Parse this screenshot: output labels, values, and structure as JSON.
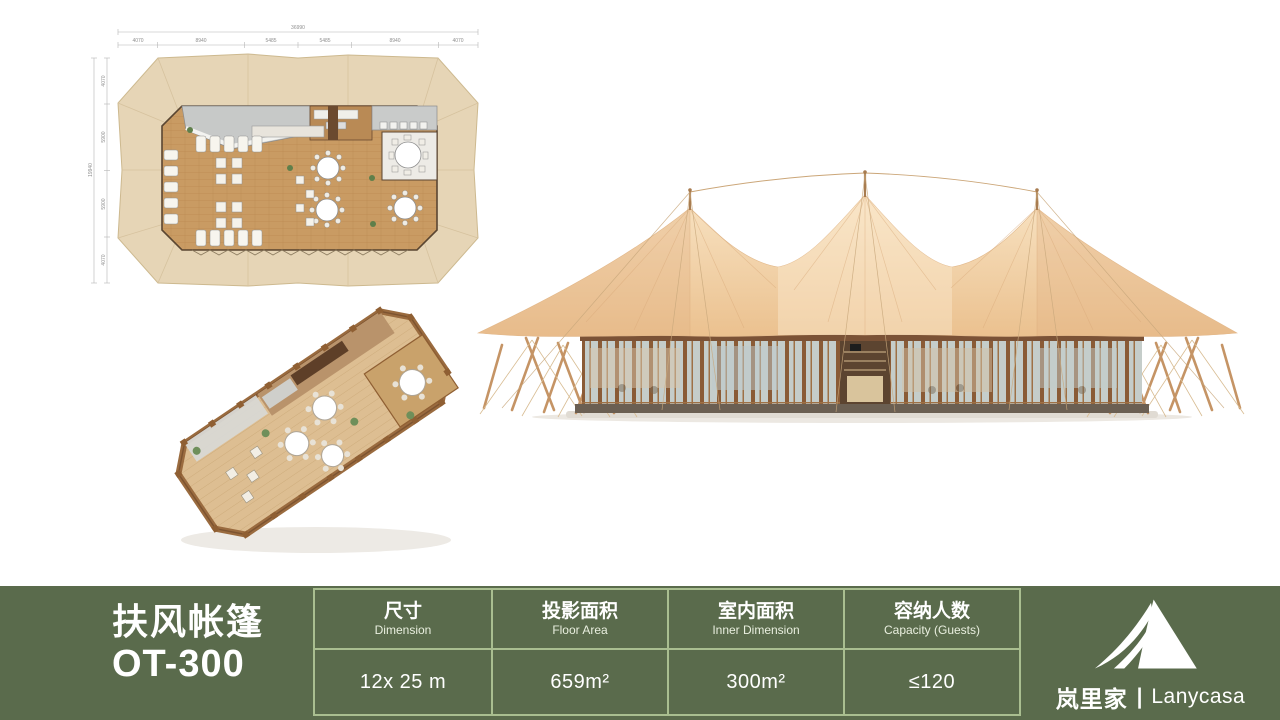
{
  "product": {
    "name_cn": "扶风帐篷",
    "model": "OT-300"
  },
  "spec_table": {
    "columns": [
      {
        "label_cn": "尺寸",
        "label_en": "Dimension",
        "value": "12x 25 m"
      },
      {
        "label_cn": "投影面积",
        "label_en": "Floor Area",
        "value": "659m²"
      },
      {
        "label_cn": "室内面积",
        "label_en": "Inner Dimension",
        "value": "300m²"
      },
      {
        "label_cn": "容纳人数",
        "label_en": "Capacity (Guests)",
        "value": "≤120"
      }
    ]
  },
  "brand": {
    "name_cn": "岚里家",
    "separator": "|",
    "name_en": "Lanycasa"
  },
  "floor_plan_dimensions": {
    "top_total": "36990",
    "top_segments": [
      "4070",
      "8940",
      "5485",
      "5485",
      "8940",
      "4070"
    ],
    "left_total": "19940",
    "left_segments": [
      "4070",
      "5900",
      "5900",
      "4070"
    ]
  },
  "colors": {
    "bar_green": "#5A6B4C",
    "divider_green": "#A9BE90",
    "canopy_beige": "#F2D3A8",
    "plan_footprint": "#E6D5B6",
    "wood_floor": "#C99B63",
    "frame_brown": "#8A5B36"
  }
}
